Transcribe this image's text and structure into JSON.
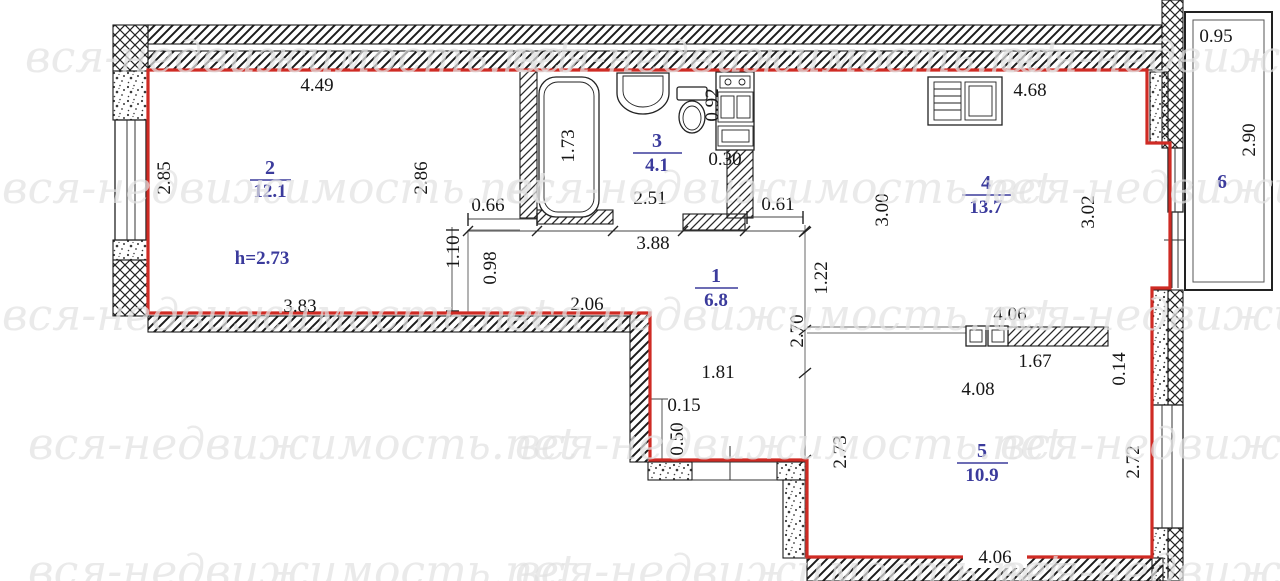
{
  "watermark": {
    "text": "вся-недвижимость.net"
  },
  "colors": {
    "outline_red": "#cf2b24",
    "label_blue": "#3b3b9c",
    "dim_black": "#161616",
    "watermark_gray": "#e3e3e3"
  },
  "ceiling_height": "h=2.73",
  "rooms": {
    "r1": {
      "number": "1",
      "area": "6.8"
    },
    "r2": {
      "number": "2",
      "area": "12.1"
    },
    "r3": {
      "number": "3",
      "area": "4.1"
    },
    "r4": {
      "number": "4",
      "area": "13.7"
    },
    "r5": {
      "number": "5",
      "area": "10.9"
    },
    "r6": {
      "number": "6"
    }
  },
  "dims": {
    "room2_top": "4.49",
    "room2_left": "2.85",
    "room2_right": "2.86",
    "room2_bottom": "3.83",
    "tub_length": "1.73",
    "bath_width": "2.51",
    "bath_total": "3.88",
    "bath_ledge": "0.66",
    "stove_depth": "0.92",
    "stove_gap": "0.30",
    "kitchen_door": "0.61",
    "nook_height": "1.10",
    "nook_width": "0.98",
    "hall_top": "2.06",
    "hall_right_upper": "1.22",
    "hall_right_lower": "2.70",
    "hall_lower_width": "1.81",
    "step_width": "0.15",
    "step_depth": "0.50",
    "hall_side": "2.73",
    "room4_top": "4.68",
    "room4_left": "3.00",
    "room4_right": "3.02",
    "balcony_width": "0.95",
    "balcony_length": "2.90",
    "room5_top": "4.06",
    "closet_width": "1.67",
    "closet_gap": "0.14",
    "room5_inner": "4.08",
    "room5_right": "2.72",
    "room5_bottom": "4.06"
  }
}
